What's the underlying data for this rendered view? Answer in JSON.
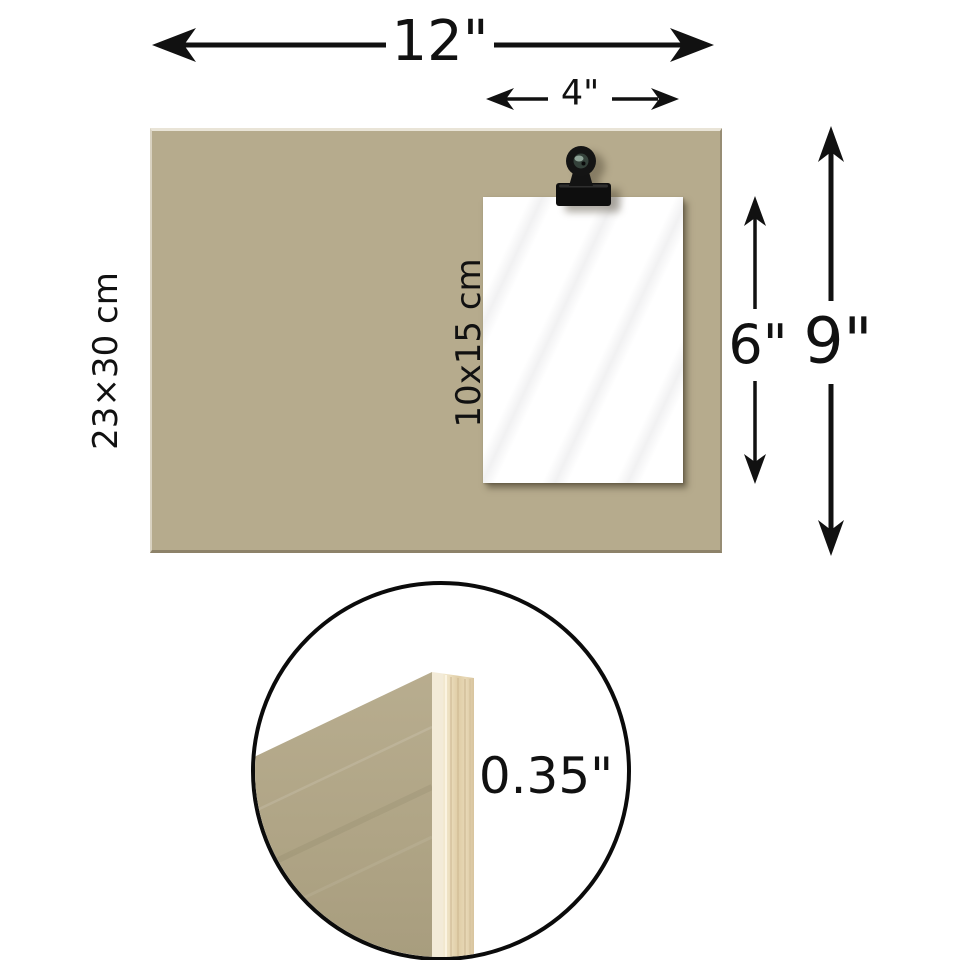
{
  "diagram": {
    "board": {
      "width_label": "12\"",
      "height_label": "9\"",
      "metric_label": "23×30 cm"
    },
    "photo": {
      "width_label": "4\"",
      "height_label": "6\"",
      "metric_label": "10x15 cm"
    },
    "thickness": {
      "label": "0.35\""
    },
    "icons": {
      "clip": "binder-clip"
    },
    "colors": {
      "board_surface": "#b6ab8d",
      "board_edge_dark": "#8d8269",
      "wood_face": "#b0a586",
      "wood_edge_light": "#f2e9d3",
      "wood_edge_mid": "#dfcda6",
      "paper": "#ffffff",
      "clip_black": "#141414",
      "arrow_black": "#111111",
      "background": "#ffffff"
    }
  }
}
